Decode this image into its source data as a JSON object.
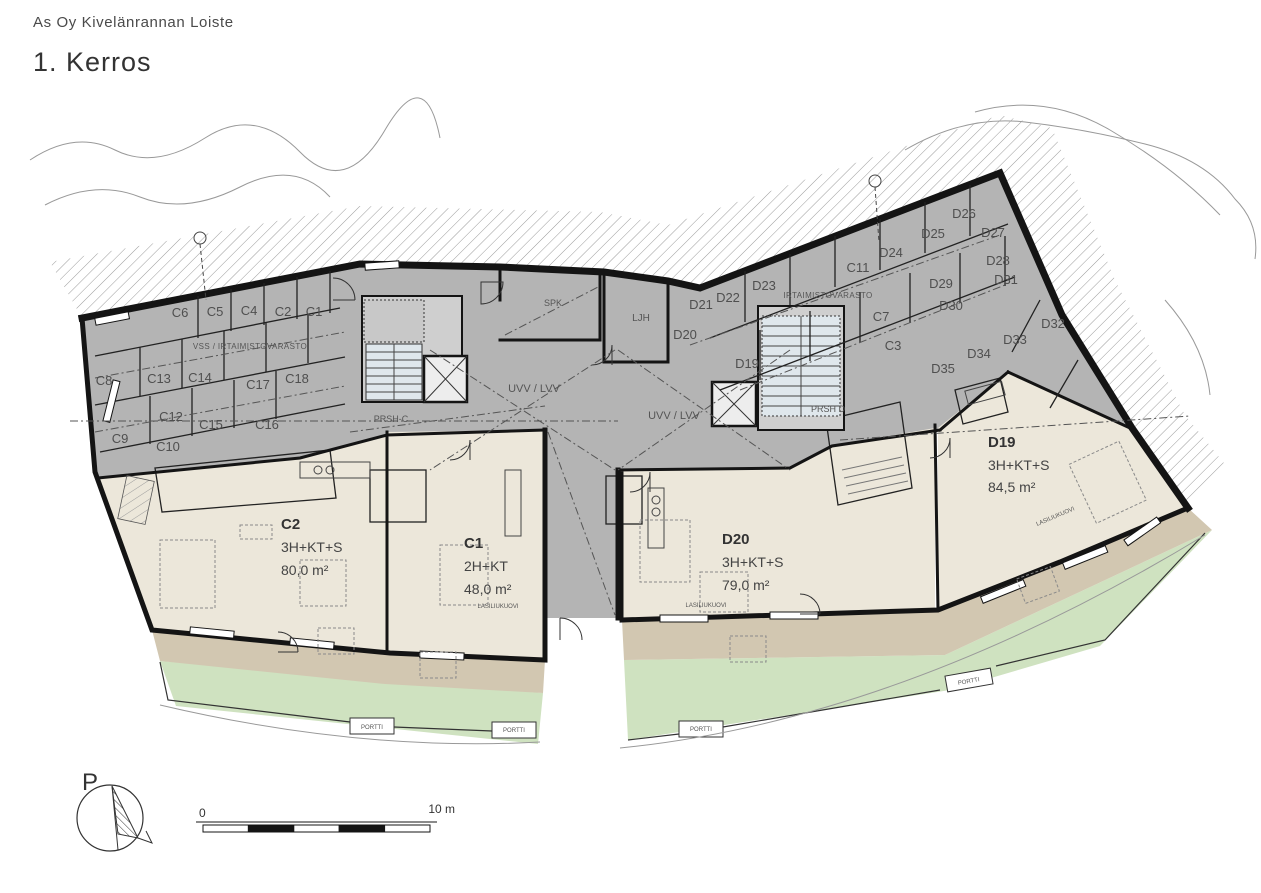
{
  "header": {
    "project": "As Oy Kivelänrannan Loiste",
    "floor": "1. Kerros"
  },
  "apartments": {
    "c2": {
      "id": "C2",
      "type": "3H+KT+S",
      "area": "80,0 m²"
    },
    "c1": {
      "id": "C1",
      "type": "2H+KT",
      "area": "48,0 m²"
    },
    "d20": {
      "id": "D20",
      "type": "3H+KT+S",
      "area": "79,0 m²"
    },
    "d19": {
      "id": "D19",
      "type": "3H+KT+S",
      "area": "84,5 m²"
    }
  },
  "storage": {
    "left_block_label": "VSS / IRTAIMISTOVARASTO",
    "right_block_label": "IRTAIMISTOVARASTO",
    "c": {
      "c1": "C1",
      "c2": "C2",
      "c3": "C3",
      "c4": "C4",
      "c5": "C5",
      "c6": "C6",
      "c7": "C7",
      "c8": "C8",
      "c9": "C9",
      "c10": "C10",
      "c11": "C11",
      "c12": "C12",
      "c13": "C13",
      "c14": "C14",
      "c15": "C15",
      "c16": "C16",
      "c17": "C17",
      "c18": "C18"
    },
    "d": {
      "d19": "D19",
      "d20": "D20",
      "d21": "D21",
      "d22": "D22",
      "d23": "D23",
      "d24": "D24",
      "d25": "D25",
      "d26": "D26",
      "d27": "D27",
      "d28": "D28",
      "d29": "D29",
      "d30": "D30",
      "d31": "D31",
      "d32": "D32",
      "d33": "D33",
      "d34": "D34",
      "d35": "D35"
    }
  },
  "common_rooms": {
    "spk": "SPK",
    "ljh": "LJH",
    "uvv_left": "UVV / LVV",
    "uvv_right": "UVV / LVV",
    "prsh_c": "PRSH-C",
    "prsh_d": "PRSH D"
  },
  "annotations": {
    "sliding_door": "LASILIUKUOVI",
    "gate": "PORTTI"
  },
  "compass": {
    "north_label": "P"
  },
  "scale_bar": {
    "zero_label": "0",
    "end_label": "10 m"
  },
  "colors": {
    "storage_gray": "#b4b4b4",
    "stair_gray": "#cfcfcf",
    "apartment_cream": "#ece7da",
    "terrace_tan": "#d2c7b1",
    "yard_green": "#cfe2c0",
    "wet_room_blue": "#d9ecf4",
    "wall_black": "#141414"
  }
}
